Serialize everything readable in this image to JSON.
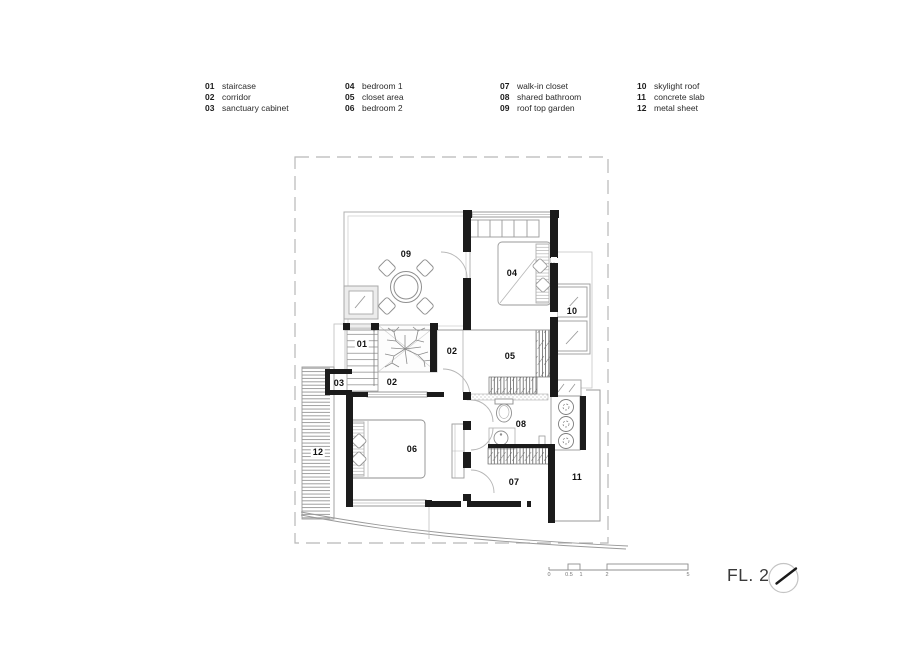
{
  "legend": {
    "columns": [
      {
        "items": [
          {
            "num": "01",
            "label": "staircase"
          },
          {
            "num": "02",
            "label": "corridor"
          },
          {
            "num": "03",
            "label": "sanctuary cabinet"
          }
        ]
      },
      {
        "items": [
          {
            "num": "04",
            "label": "bedroom 1"
          },
          {
            "num": "05",
            "label": "closet area"
          },
          {
            "num": "06",
            "label": "bedroom 2"
          }
        ]
      },
      {
        "items": [
          {
            "num": "07",
            "label": "walk-in closet"
          },
          {
            "num": "08",
            "label": "shared bathroom"
          },
          {
            "num": "09",
            "label": "roof top garden"
          }
        ]
      },
      {
        "items": [
          {
            "num": "10",
            "label": "skylight roof"
          },
          {
            "num": "11",
            "label": "concrete slab"
          },
          {
            "num": "12",
            "label": "metal sheet"
          }
        ]
      }
    ]
  },
  "plan": {
    "labels": [
      "09",
      "04",
      "10",
      "01",
      "02",
      "05",
      "03",
      "02",
      "08",
      "12",
      "06",
      "11",
      "07"
    ]
  },
  "scale_bar": {
    "ticks": [
      "0",
      "0.5",
      "1",
      "2",
      "5"
    ]
  },
  "floor_label": "FL. 2",
  "icons": {
    "compass": "north-arrow"
  },
  "colors": {
    "wall": "#1b1b1b",
    "line": "#9a9a9a",
    "light_line": "#c2c2c2",
    "dashed_boundary": "#b8b8b8",
    "text": "#1a1a1a"
  }
}
